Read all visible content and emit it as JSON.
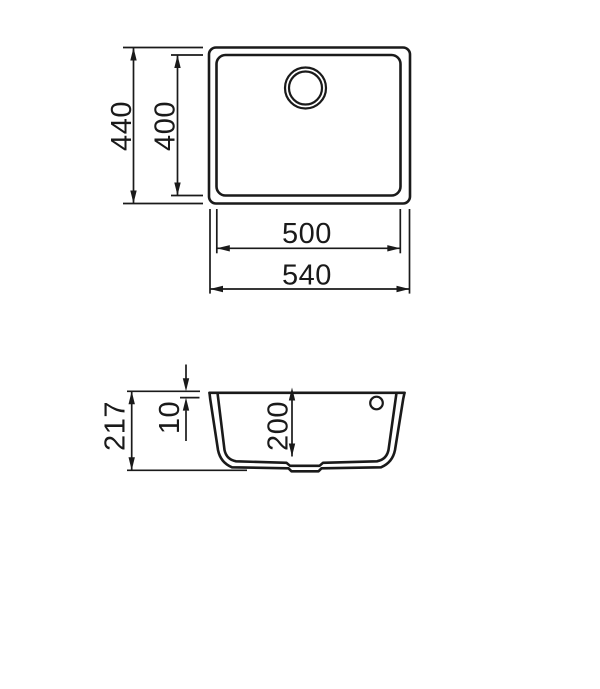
{
  "drawing": {
    "type": "sink-technical-drawing",
    "colors": {
      "line": "#1a1a1a",
      "background": "#ffffff"
    },
    "top_view": {
      "outer_height_mm": "440",
      "inner_height_mm": "400",
      "inner_width_mm": "500",
      "outer_width_mm": "540"
    },
    "section_view": {
      "total_depth_mm": "217",
      "rim_offset_mm": "10",
      "bowl_depth_mm": "200"
    }
  }
}
